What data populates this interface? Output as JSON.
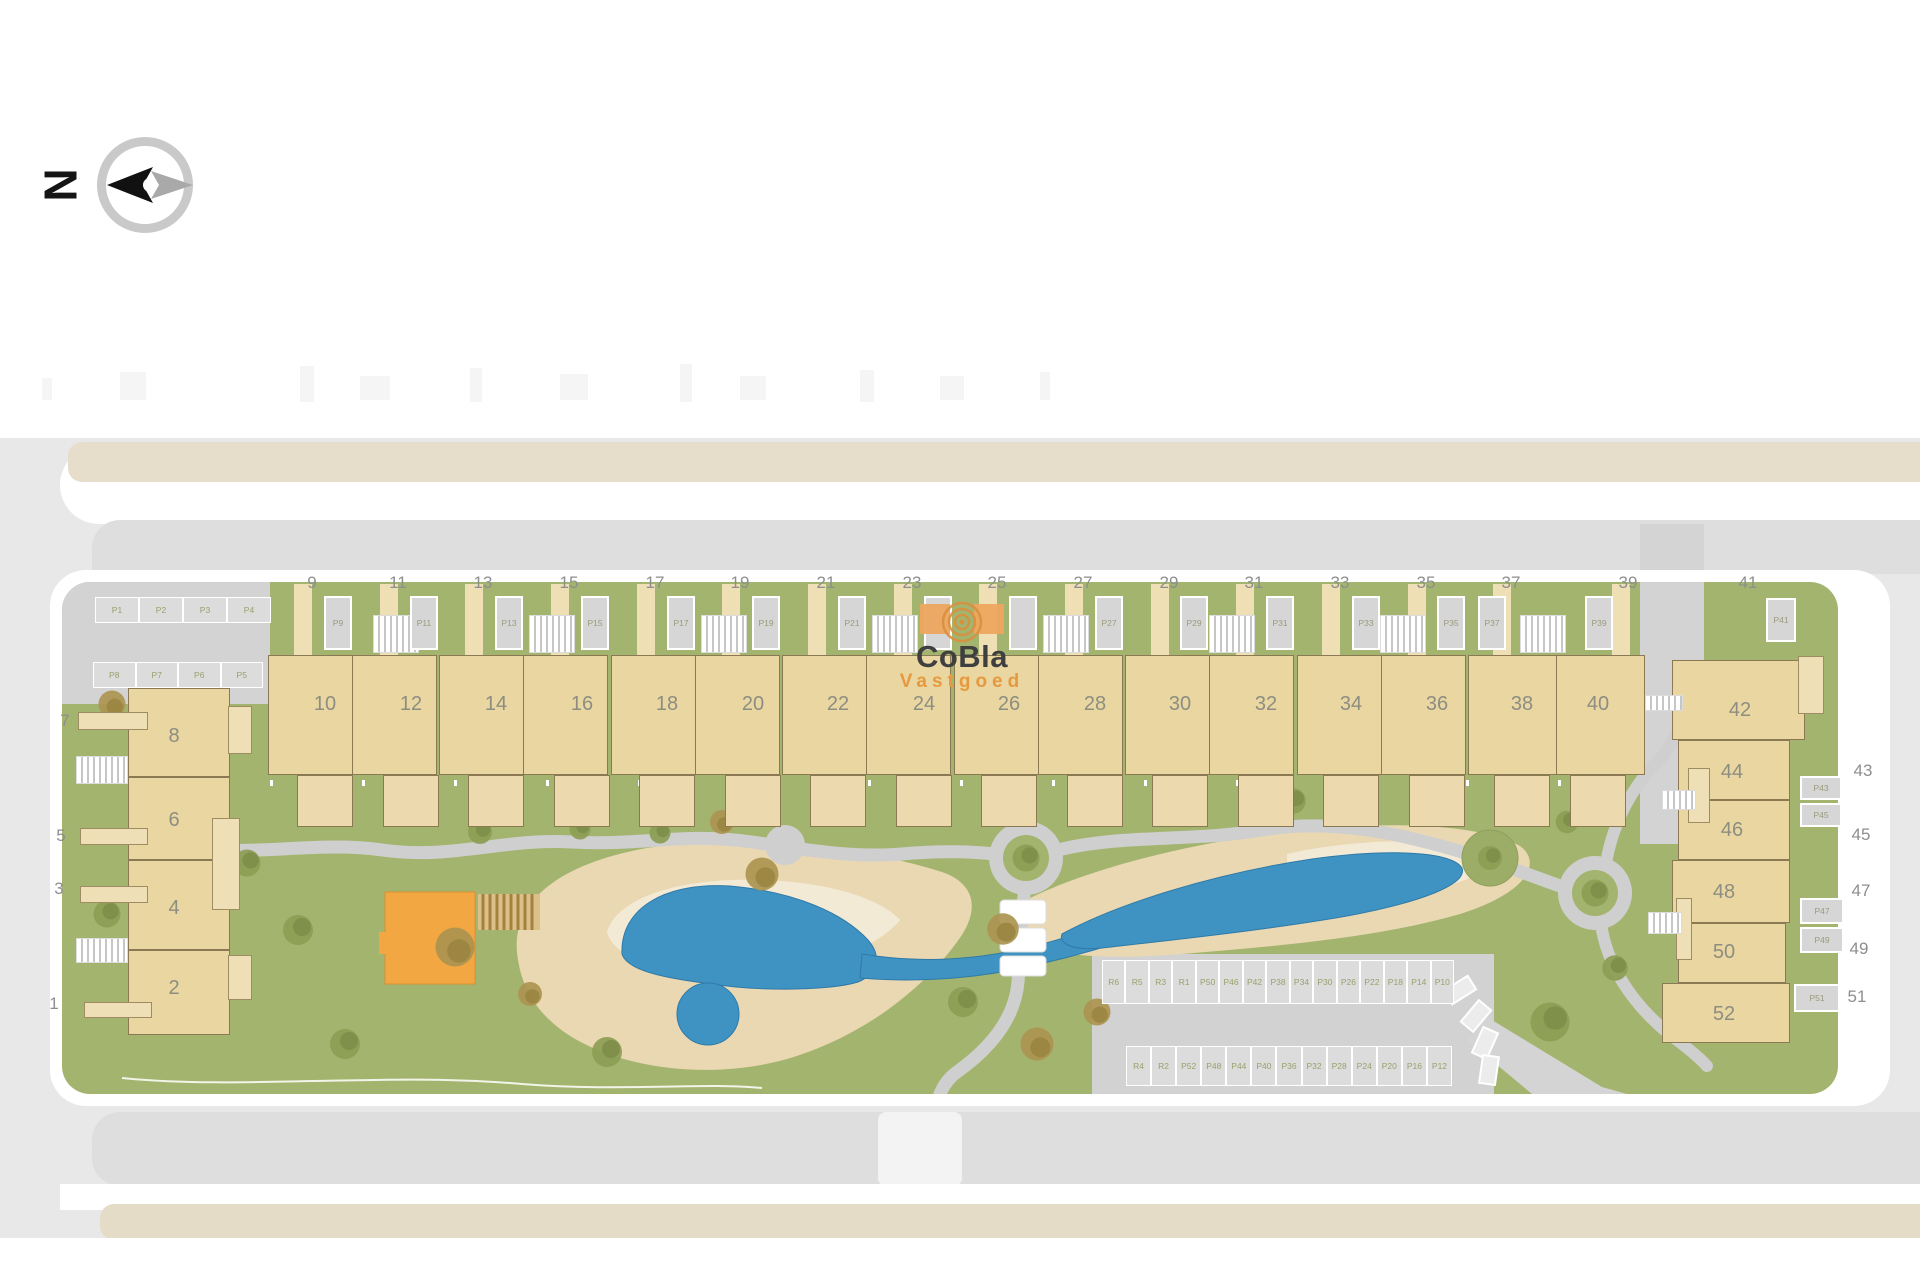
{
  "brand": {
    "name": "CoBla",
    "tagline": "Vastgoed",
    "accent": "#e8993f"
  },
  "compass": {
    "north": "N"
  },
  "colors": {
    "grass": "#a3b46e",
    "sand": "#ead8b2",
    "water": "#3f93c2",
    "building": "#e9d6a0",
    "road": "#d4d4d4",
    "playground": "#f3a743"
  },
  "top_left_parking": {
    "row1": [
      "P1",
      "P2",
      "P3",
      "P4"
    ],
    "row2": [
      "P8",
      "P7",
      "P6",
      "P5"
    ]
  },
  "left_block": {
    "street": [
      "7",
      "5",
      "3",
      "1"
    ],
    "houses": [
      "8",
      "6",
      "4",
      "2"
    ]
  },
  "top_row": {
    "street": [
      "9",
      "11",
      "13",
      "15",
      "17",
      "19",
      "21",
      "23",
      "25",
      "27",
      "29",
      "31",
      "33",
      "35",
      "37",
      "39"
    ],
    "houses": [
      "10",
      "12",
      "14",
      "16",
      "18",
      "20",
      "22",
      "24",
      "26",
      "28",
      "30",
      "32",
      "34",
      "36",
      "38",
      "40"
    ],
    "pads": [
      "P9",
      "P11",
      "P13",
      "P15",
      "P17",
      "P19",
      "P21",
      "P23",
      "P25",
      "P27",
      "P29",
      "P31",
      "P33",
      "P35",
      "P37",
      "P39"
    ]
  },
  "right_block": {
    "street": [
      "41",
      "43",
      "45",
      "47",
      "49",
      "51"
    ],
    "houses": [
      "42",
      "44",
      "46",
      "48",
      "50",
      "52"
    ],
    "pads": [
      "P41",
      "P43",
      "P45",
      "P47",
      "P49",
      "P51"
    ]
  },
  "central_parking": {
    "row1": [
      "R6",
      "R5",
      "R3",
      "R1",
      "P50",
      "P46",
      "P42",
      "P38",
      "P34",
      "P30",
      "P26",
      "P22",
      "P18",
      "P14",
      "P10"
    ],
    "row2": [
      "R4",
      "R2",
      "P52",
      "P48",
      "P44",
      "P40",
      "P36",
      "P32",
      "P28",
      "P24",
      "P20",
      "P16",
      "P12"
    ]
  }
}
